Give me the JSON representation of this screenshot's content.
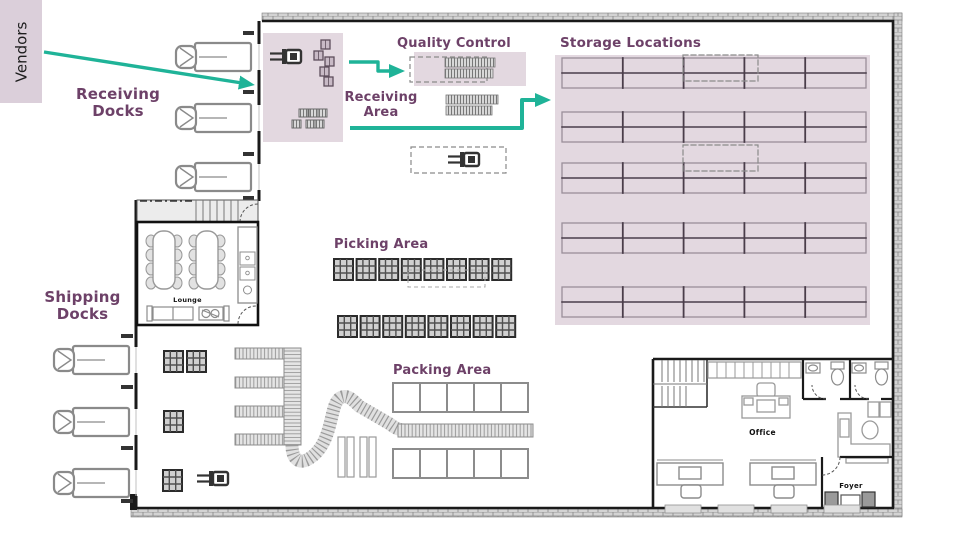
{
  "colors": {
    "zone_fill": "#e3d8e0",
    "vendors_box_fill": "#dbcfda",
    "label_purple": "#6d4168",
    "arrow_teal": "#1fb398",
    "wall_black": "#1a1a1a",
    "furniture_gray": "#8c8c8c"
  },
  "labels": {
    "vendors": "Vendors",
    "receiving_docks": "Receiving Docks",
    "quality_control": "Quality Control",
    "storage_locations": "Storage Locations",
    "receiving_area": "Receiving Area",
    "picking_area": "Picking Area",
    "shipping_docks": "Shipping Docks",
    "packing_area": "Packing Area"
  },
  "rooms": {
    "lounge": "Lounge",
    "office": "Office",
    "foyer": "Foyer"
  },
  "flows": [
    {
      "name": "vendors-to-receiving-area"
    },
    {
      "name": "receiving-area-to-quality-control"
    },
    {
      "name": "receiving-area-to-storage-locations"
    }
  ]
}
